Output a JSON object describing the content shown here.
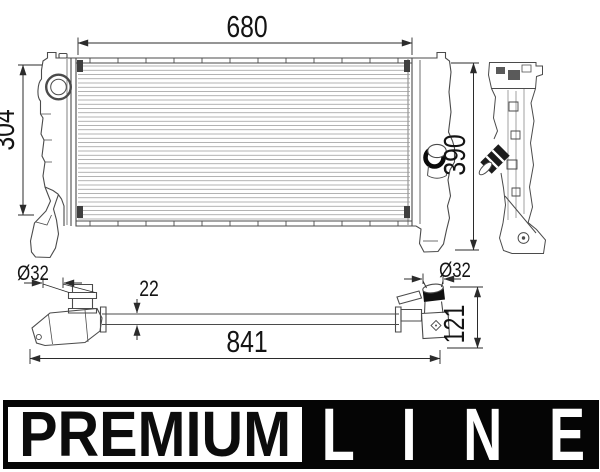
{
  "drawing": {
    "dims": {
      "core_width": "680",
      "left_height": "304",
      "right_height": "390",
      "inlet_diameter": "Ø32",
      "bar_thickness": "22",
      "outlet_diameter": "Ø32",
      "end_depth": "121",
      "overall_length": "841"
    },
    "fins": {
      "x1": 78,
      "x2": 410,
      "y1": 66,
      "y2": 219,
      "count": 37
    },
    "header_ticks": {
      "x1": 90,
      "x2": 398,
      "count": 12,
      "top_y1": 58.5,
      "top_y2": 62.5,
      "bottom_y1": 221.5,
      "bottom_y2": 225.5
    },
    "stroke": {
      "part": "#4b4b4b",
      "fine": "#9a9a9a",
      "dim": "#2b2b2b",
      "text": "#141414"
    }
  },
  "brand": {
    "premium": "PREMIUM",
    "line": "LINE",
    "band_color": "#050505",
    "box_color": "#ffffff",
    "premium_text_color": "#0c0c0c",
    "line_text_color": "#ffffff"
  }
}
